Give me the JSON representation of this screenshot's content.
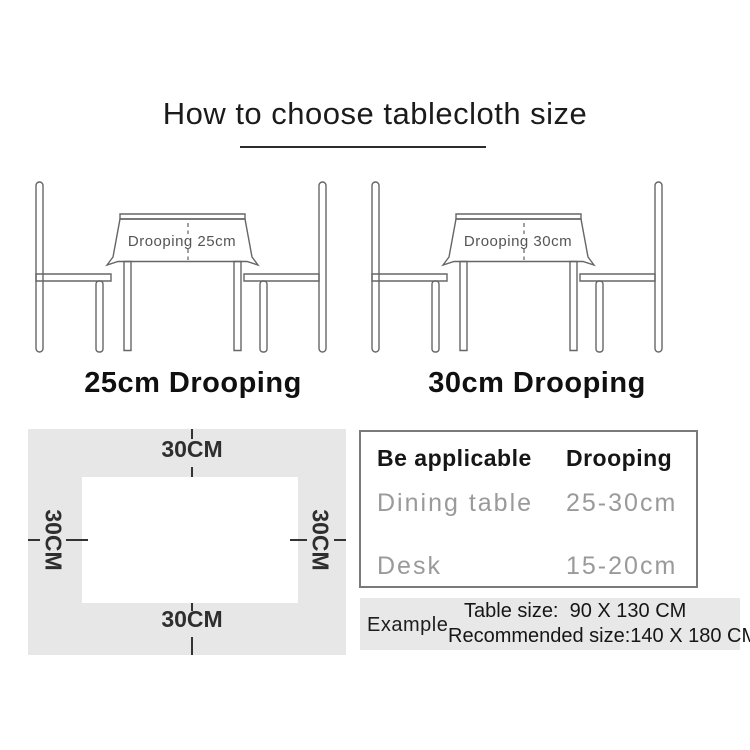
{
  "title": "How to choose tablecloth size",
  "diagrams": {
    "left": {
      "drooping_text": "Drooping 25cm",
      "caption": "25cm Drooping"
    },
    "right": {
      "drooping_text": "Drooping 30cm",
      "caption": "30cm Drooping"
    }
  },
  "size_diagram": {
    "top_label": "30CM",
    "bottom_label": "30CM",
    "left_label": "30CM",
    "right_label": "30CM"
  },
  "spec_table": {
    "header": {
      "col1": "Be applicable",
      "col2": "Drooping"
    },
    "rows": [
      {
        "name": "Dining table",
        "value": "25-30cm"
      },
      {
        "name": "Desk",
        "value": "15-20cm"
      }
    ]
  },
  "example": {
    "label": "Example",
    "table_size_line": "Table size:  90 X 130 CM",
    "recommended_line": "Recommended size:140 X 180 CM"
  },
  "colors": {
    "panel_gray": "#e7e7e7",
    "example_gray": "#e8e8e8",
    "line_stroke": "#666666",
    "text_dark": "#1b1b1b",
    "text_gray": "#9a9a9a"
  }
}
